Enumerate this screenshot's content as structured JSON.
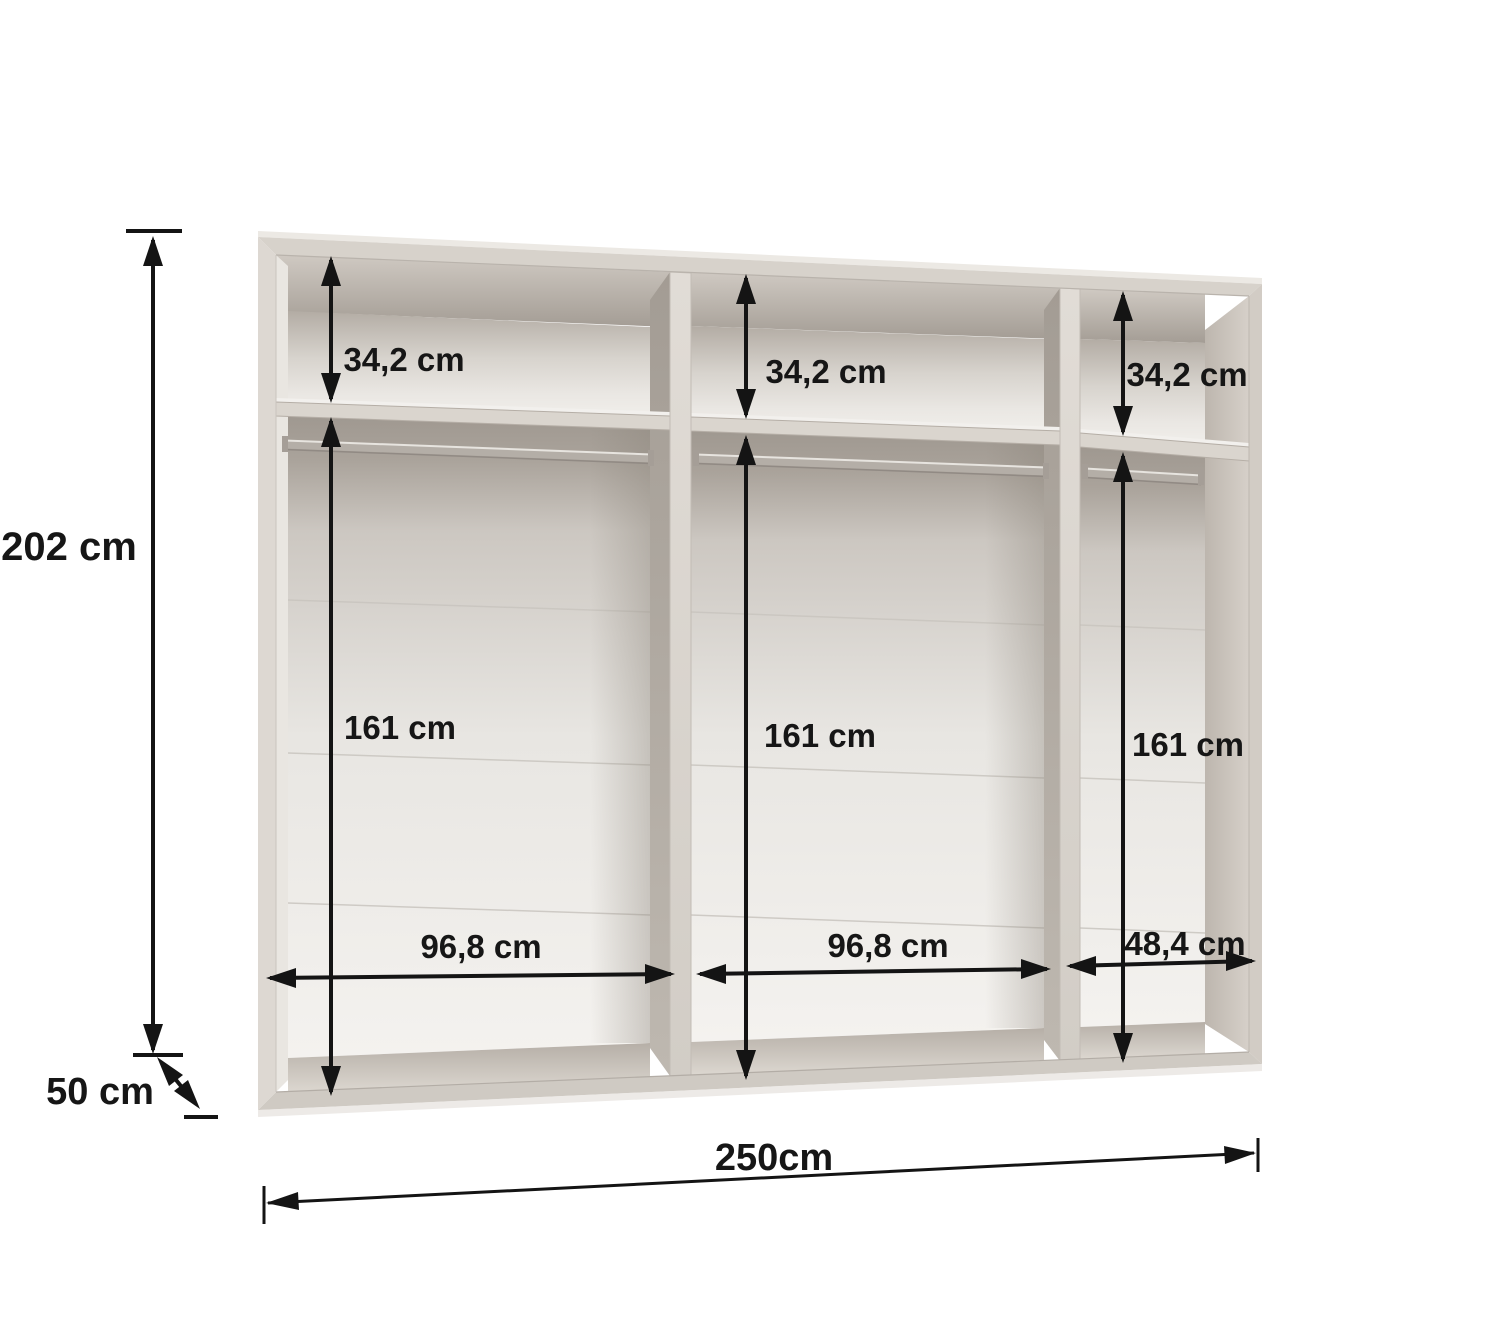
{
  "diagram": {
    "type": "wardrobe-interior-dimension-drawing",
    "overall": {
      "height_label": "202 cm",
      "depth_label": "50 cm",
      "total_width_label": "250cm"
    },
    "sections": [
      {
        "top_compartment_height_label": "34,2 cm",
        "hanging_area_height_label": "161 cm",
        "width_label": "96,8 cm"
      },
      {
        "top_compartment_height_label": "34,2 cm",
        "hanging_area_height_label": "161 cm",
        "width_label": "96,8 cm"
      },
      {
        "top_compartment_height_label": "34,2 cm",
        "hanging_area_height_label": "161 cm",
        "width_label": "48,4 cm"
      }
    ],
    "colors": {
      "dimension_ink": "#141414",
      "carcass_front": "#d7d2cb",
      "interior_shadow": "#a8a199",
      "back_panel_light": "#f3f1ee",
      "background": "#ffffff"
    }
  }
}
